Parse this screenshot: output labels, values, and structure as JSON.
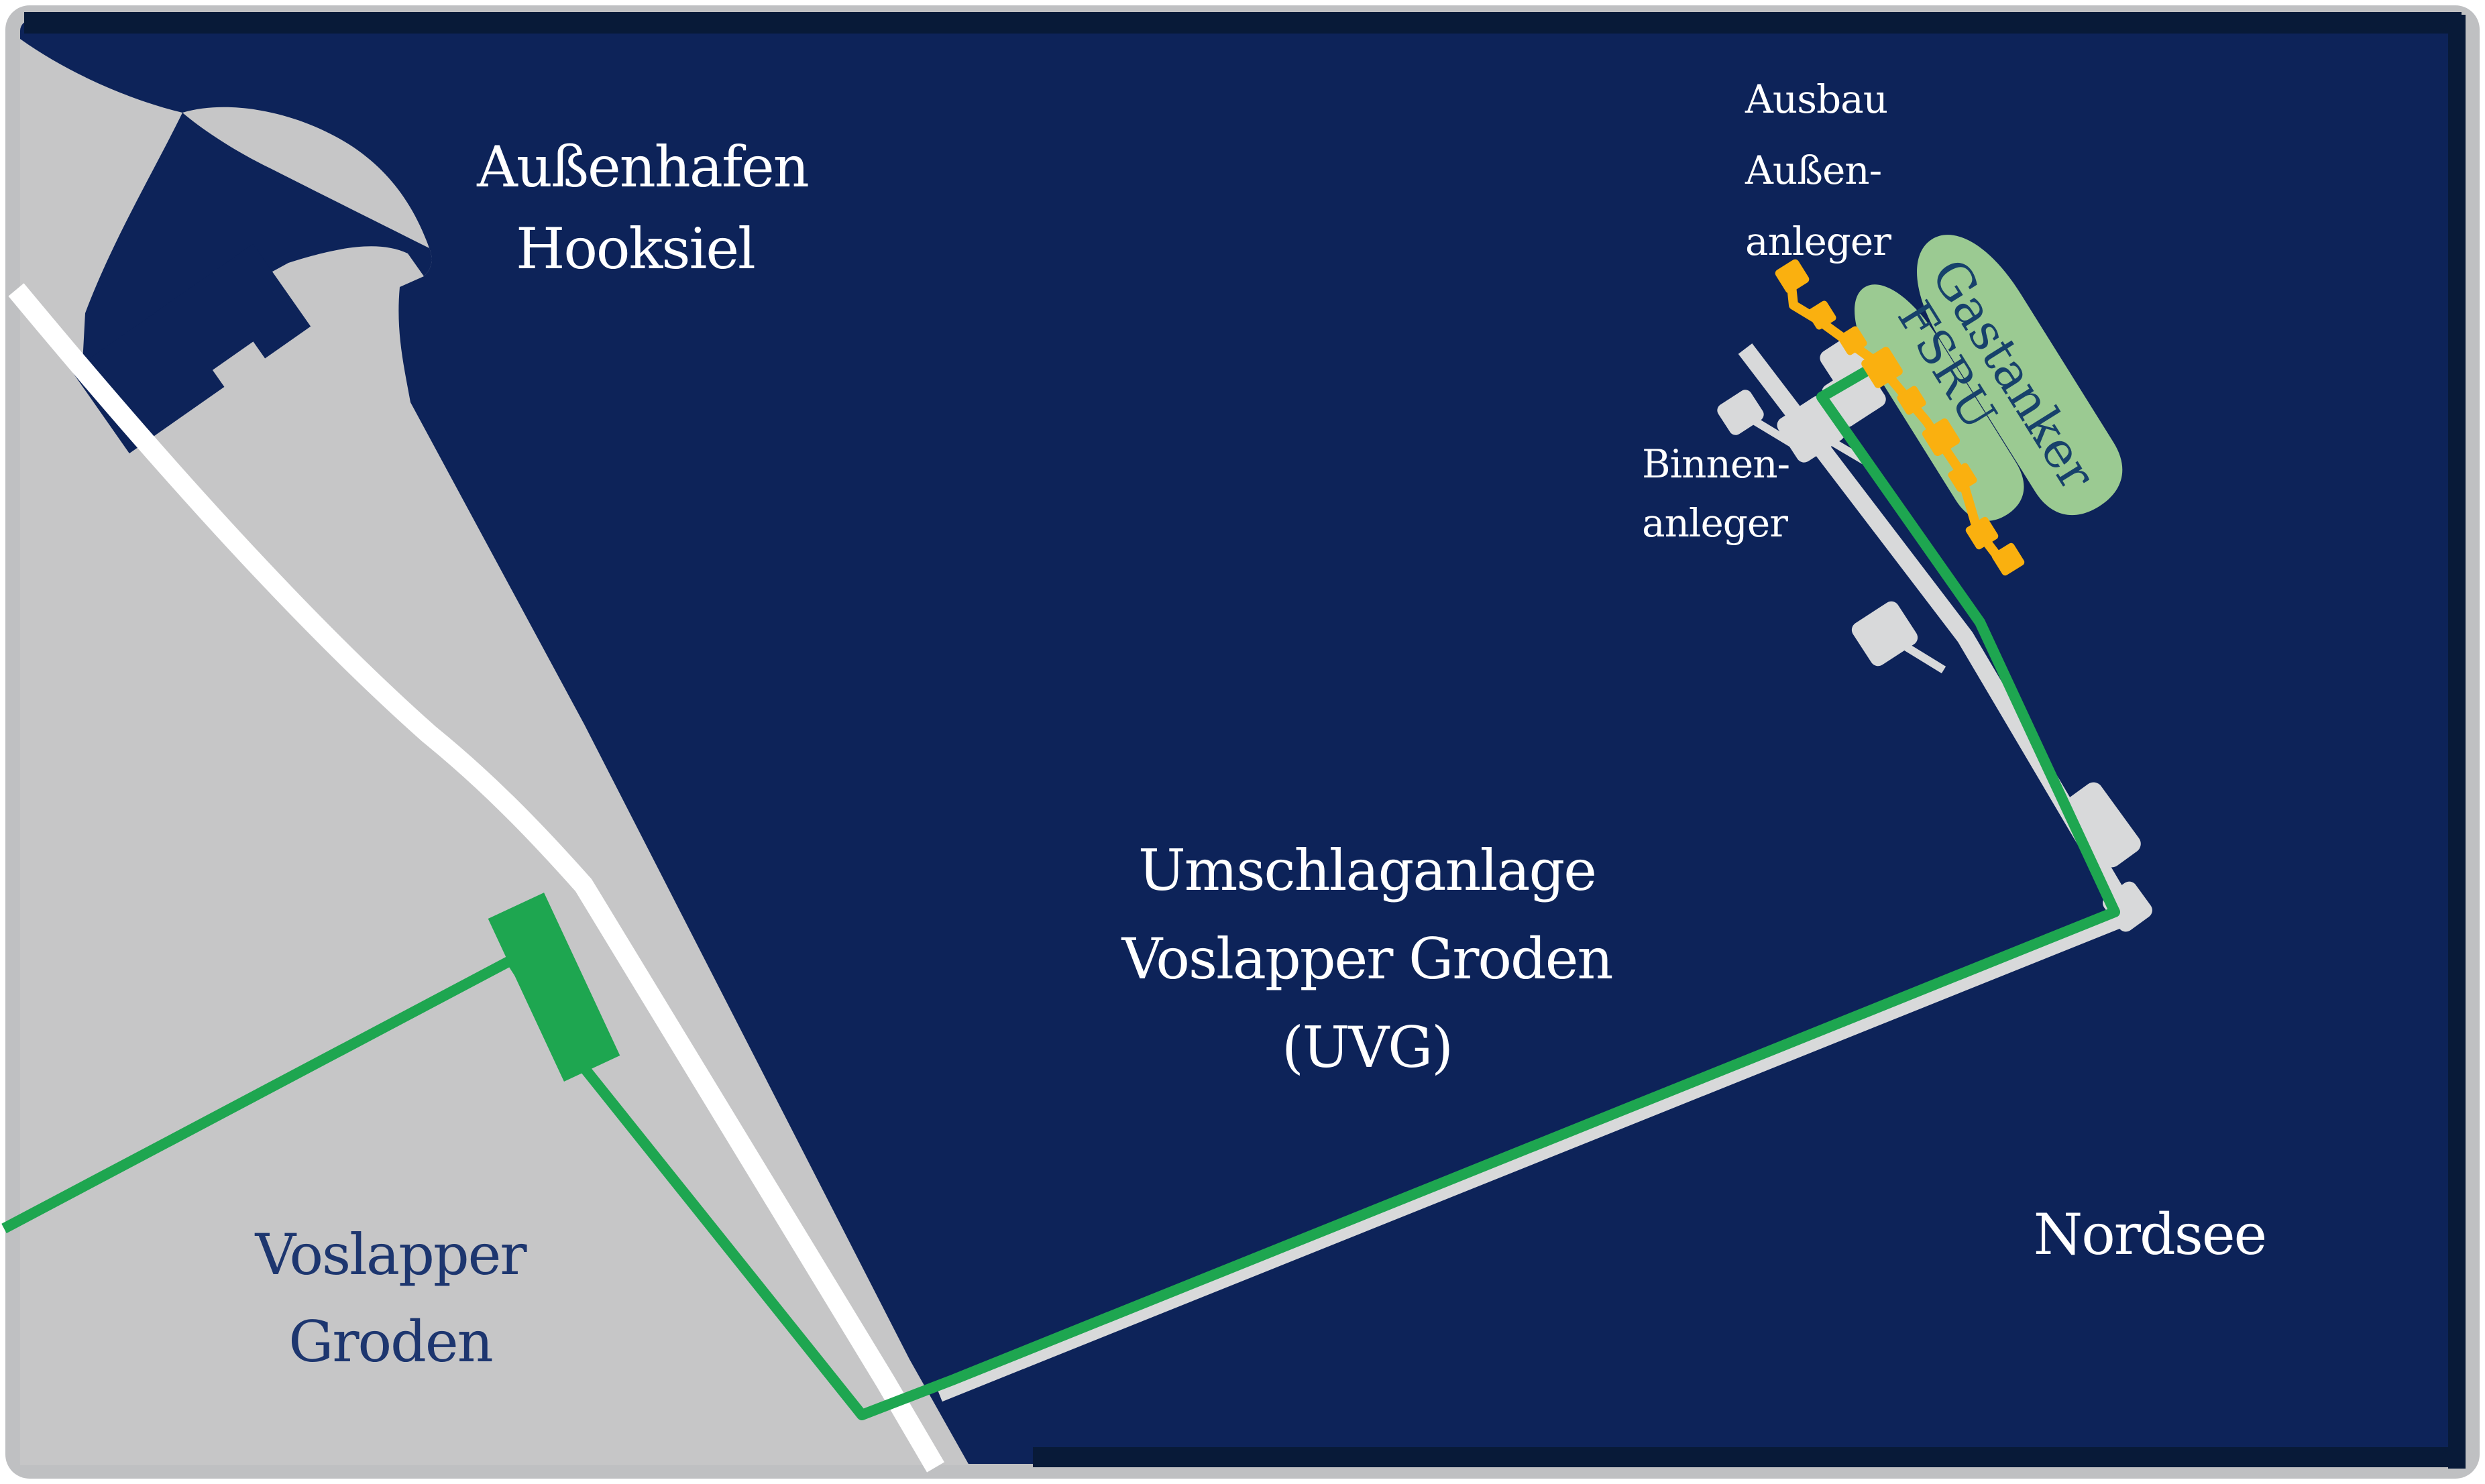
{
  "map": {
    "type": "schematic-harbor-map",
    "region_sea": "Nordsee",
    "facility": "Umschlaganlage Voslapper Groden (UVG)"
  },
  "labels": {
    "hooksiel": {
      "lines": [
        "Außenhafen",
        "Hooksiel"
      ]
    },
    "ausbau": {
      "lines": [
        "Ausbau",
        "Außen-",
        "anleger"
      ]
    },
    "binnen": {
      "lines": [
        "Binnen-",
        "anleger"
      ]
    },
    "uvg": {
      "lines": [
        "Umschlaganlage",
        "Voslapper Groden",
        "(UVG)"
      ]
    },
    "nordsee": {
      "text": "Nordsee"
    },
    "voslapper_groden": {
      "lines": [
        "Voslapper",
        "Groden"
      ]
    },
    "ships": {
      "gastanker": "Gastanker",
      "fsru": "FSRU"
    }
  },
  "colors": {
    "water_navy": "#0d2359",
    "edge_shadow_navy": "#081a38",
    "frame_gray": "#bfc0c2",
    "land_gray": "#c6c6c7",
    "pier_gray": "#d8d9da",
    "road_white": "#ffffff",
    "pipeline_green": "#1ea650",
    "plant_green": "#1ea650",
    "ship_green": "#9bca92",
    "berth_yellow": "#fab00f",
    "label_white": "#ffffff",
    "label_navy": "#1d366f",
    "ship_text_navy": "#17416b"
  }
}
